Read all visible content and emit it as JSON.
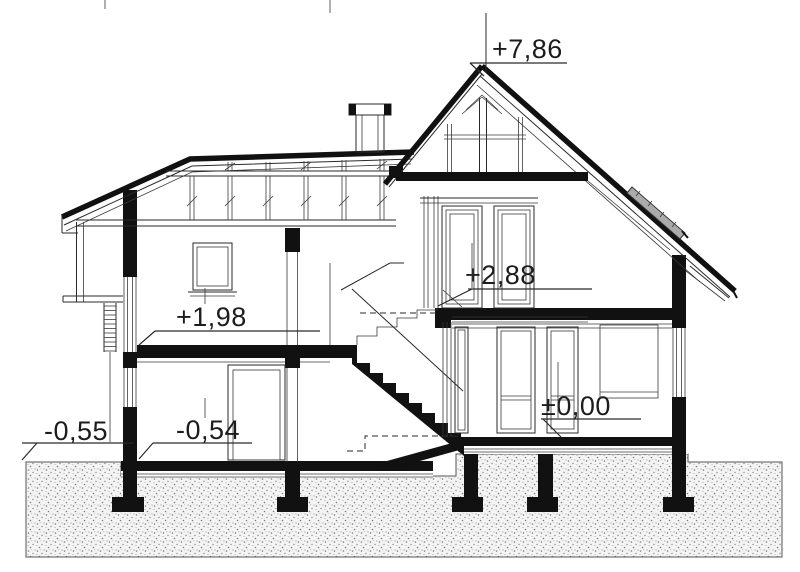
{
  "drawing": {
    "type": "house-cross-section",
    "levels": [
      {
        "id": "ridge",
        "label": "+7,86"
      },
      {
        "id": "upper-floor-right",
        "label": "+2,88"
      },
      {
        "id": "upper-floor-left",
        "label": "+1,98"
      },
      {
        "id": "ground-floor",
        "label": "±0,00"
      },
      {
        "id": "ground-floor-left",
        "label": "-0,54"
      },
      {
        "id": "exterior-grade",
        "label": "-0,55"
      }
    ],
    "colors": {
      "line": "#1c1c1c",
      "paper": "#ffffff",
      "ground_dots": "#7d7d7d",
      "roof_window": "#ababab"
    }
  }
}
